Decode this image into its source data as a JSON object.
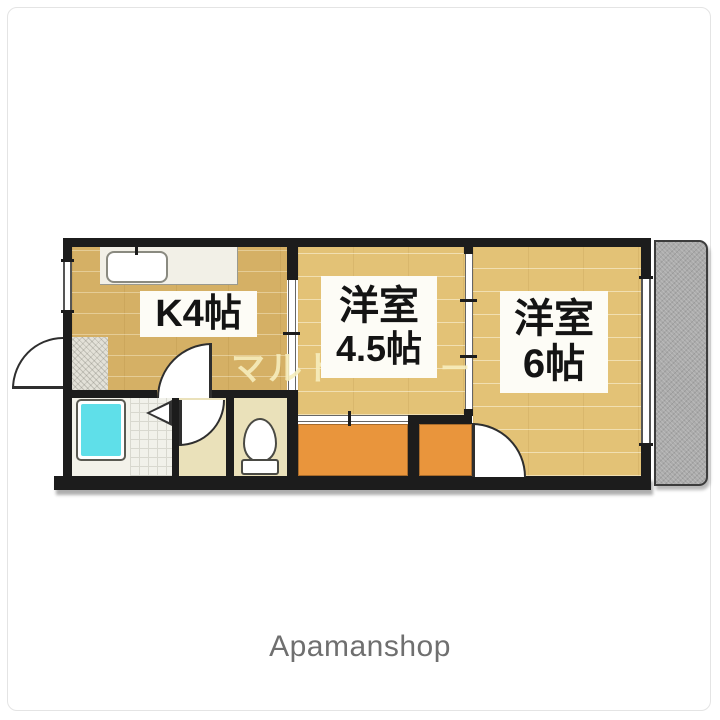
{
  "colors": {
    "wall": "#1c1c1c",
    "floor_tan": "#e3c276",
    "kitchen_floor": "#d5b065",
    "hall_cream": "#eae1ba",
    "closet_orange": "#e9953c",
    "tub_cyan": "#5fdfe9",
    "balcony_gray": "#ababab",
    "label_bg": "#fdfcf6",
    "text": "#141414",
    "watermark": "#f7eebd",
    "brand": "#6f6f6f"
  },
  "plan": {
    "rooms": {
      "kitchen": {
        "label": "K4帖"
      },
      "western_45": {
        "line1": "洋室",
        "line2": "4.5帖"
      },
      "western_6": {
        "line1": "洋室",
        "line2": "6帖"
      }
    },
    "watermark": {
      "left": "マルト",
      "right": "ー"
    }
  },
  "footer": {
    "brand": "Apamanshop"
  }
}
